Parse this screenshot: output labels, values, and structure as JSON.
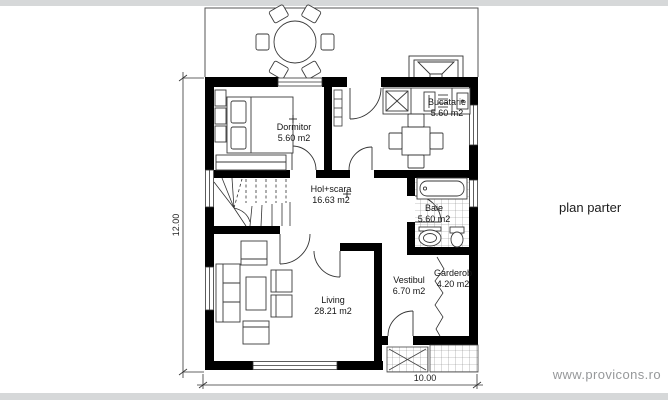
{
  "title": "plan parter",
  "watermark": "www.provicons.ro",
  "rooms": {
    "dormitor": {
      "name": "Dormitor",
      "area": "5.60 m2"
    },
    "bucatarie": {
      "name": "Bucatarie",
      "area": "5.60 m2"
    },
    "hol": {
      "name": "Hol+scara",
      "area": "16.63 m2"
    },
    "baie": {
      "name": "Baie",
      "area": "5.60 m2"
    },
    "living": {
      "name": "Living",
      "area": "28.21 m2"
    },
    "vestibul": {
      "name": "Vestibul",
      "area": "6.70 m2"
    },
    "garderob": {
      "name": "Garderob",
      "area": "4.20 m2"
    }
  },
  "dimensions": {
    "height_label": "12.00",
    "width_label": "10.00"
  },
  "colors": {
    "wall": "#000000",
    "line": "#3a3a3a",
    "tile": "#8a8a8a",
    "watermark": "#96989a",
    "edge_bar": "#d6d8d9"
  }
}
